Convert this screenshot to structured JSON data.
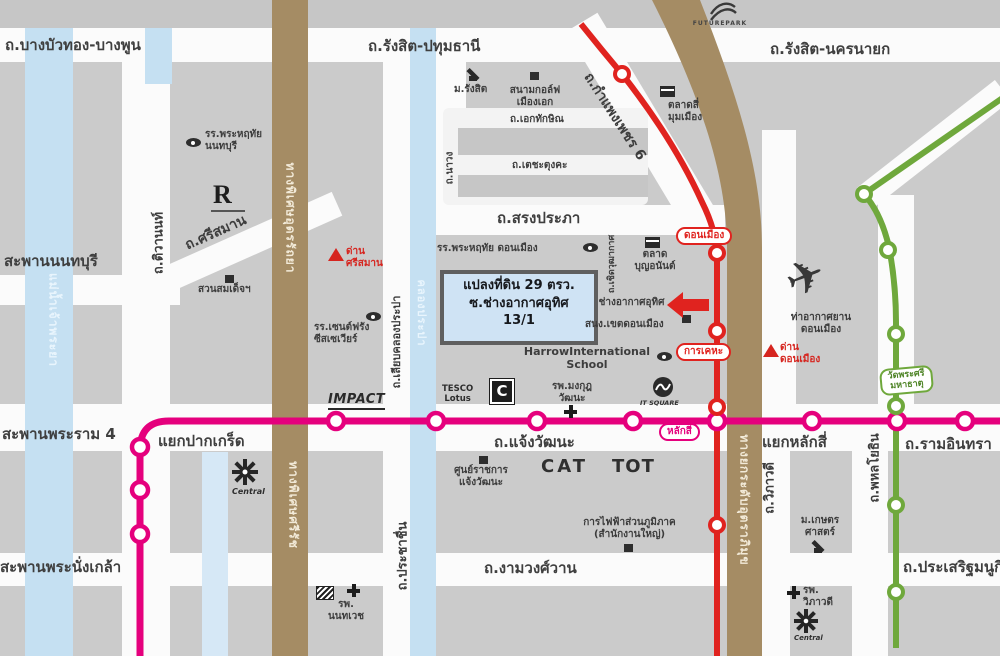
{
  "roads": {
    "bangbuathong": "ถ.บางบัวทอง-บางพูน",
    "rangsit_pathumthani": "ถ.รังสิต-ปทุมธานี",
    "rangsit_nakhonnayok": "ถ.รังสิต-นครนายก",
    "songprapha": "ถ.สรงประภา",
    "chaengwattana": "ถ.แจ้งวัฒนะ",
    "ngamwongwan": "ถ.งามวงศ์วาน",
    "ramindra": "ถ.รามอินทรา",
    "prasertmanukit": "ถ.ประเสริฐมนูกิจ",
    "srisaman": "ถ.ศรีสมาน",
    "tiwanon": "ถ.ติวานนท์",
    "ekkathaksin": "ถ.เอกทักษิณ",
    "techatungka": "ถ.เตชะตุงคะ",
    "nawong": "ถ.นาวง",
    "liap_khlong_prapa": "ถ.เลียบคลองประปา",
    "prachachuen": "ถ.ประชาชื่น",
    "choet_wutthakat": "ถ.เชิดวุฒากาศ",
    "kamphaengphet6": "ถ.กำแพงเพชร 6",
    "viphavadi": "ถ.วิภาวดี",
    "phahonyothin": "ถ.พหลโยธิน",
    "soi_chang_akat_uthit": "ซ.ช่างอากาศอุทิศ",
    "expressway_udon_ratthaya": "ทางพิเศษอุดรรัถยา",
    "expressway_si_rat": "ทางพิเศษศรีรัช",
    "tollway_uttraphimuk": "ทางยกระดับอุตราภิมุข"
  },
  "junctions": {
    "pakkret": "แยกปากเกร็ด",
    "laksi": "แยกหลักสี่"
  },
  "bridges": {
    "nonthaburi": "สะพานนนทบุรี",
    "rama4": "สะพานพระราม 4",
    "phranangklao": "สะพานพระนั่งเกล้า"
  },
  "water": {
    "chaophraya": "แม่น้ำเจ้าพระยา",
    "khlong_prapa": "คลองประปา"
  },
  "stations": {
    "donmueang": "ดอนเมือง",
    "kankheha": "การเคหะ",
    "laksi": "หลักสี่",
    "wat_phra_si": "วัดพระศรี\nมหาธาตุ"
  },
  "tolls": {
    "srisaman": "ด่าน\nศรีสมาน",
    "donmueang": "ด่าน\nดอนเมือง"
  },
  "places": {
    "phrahruethai_nonthaburi": "รร.พระหฤทัย\nนนทบุรี",
    "suan_somdet": "สวนสมเด็จฯ",
    "saint_francis": "รร.เซนต์ฟรัง\nซีสเซเวียร์",
    "rangsit_university": "ม.รังสิต",
    "muang_ake_golf": "สนามกอล์ฟ\nเมืองเอก",
    "si_mum_muang_market": "ตลาดสี่\nมุมเมือง",
    "phrahruethai_donmueang": "รร.พระหฤทัย ดอนเมือง",
    "bun_anan_market": "ตลาด\nบุญอนันต์",
    "donmueang_district_office": "สนง.เขตดอนเมือง",
    "harrow_school": "HarrowInternational\nSchool",
    "mongkutwattana_hospital": "รพ.มงกุฎ\nวัฒนะ",
    "donmueang_airport": "ท่าอากาศยาน\nดอนเมือง",
    "government_center": "ศูนย์ราชการ\nแจ้งวัฒนะ",
    "pea_hq": "การไฟฟ้าส่วนภูมิภาค\n(สำนักงานใหญ่)",
    "nonthavej_hospital": "รพ.\nนนทเวช",
    "kasetsart_university": "ม.เกษตร\nศาสตร์",
    "viphavadi_hospital": "รพ.\nวิภาวดี"
  },
  "logos": {
    "futurepark": "FUTUREPARK",
    "impact": "IMPACT",
    "tesco_lotus": "TESCO\nLotus",
    "c_mark": "C",
    "it_square": "IT SQUARE",
    "cat": "CAT",
    "tot": "TOT",
    "r_mark": "R",
    "central_pakkret": "Central",
    "central_ramindra": "Central"
  },
  "highlight": {
    "line1": "แปลงที่ดิน 29 ตรว.",
    "line2": "ซ.ช่างอากาศอุทิศ",
    "line3": "13/1"
  },
  "icons": {
    "airplane": "✈"
  },
  "colors": {
    "pink_line": "#e5007d",
    "red_line": "#e0231f",
    "green_line": "#6fa83c",
    "expressway_brown": "#a58c64",
    "water_blue": "#c5e0f2",
    "highlight_fill": "#cfe3f4",
    "label_dark": "#3d3d3d",
    "alert_red": "#d6251f"
  }
}
